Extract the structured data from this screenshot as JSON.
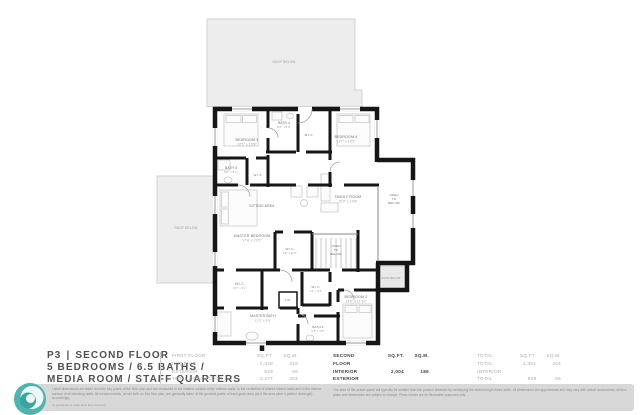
{
  "title_block": {
    "page_label": "P3",
    "separator": "|",
    "floor_label": "SECOND FLOOR",
    "line2": "5 BEDROOMS / 6.5 BATHS /",
    "line3": "MEDIA ROOM / STAFF QUARTERS"
  },
  "colors": {
    "wall": "#161616",
    "roof_fill": "#ededed",
    "accent_teal": "#4db5ad",
    "muted_text": "#9a9a9a",
    "dark_text": "#3d3d3d"
  },
  "tables": [
    {
      "header": {
        "label": "FIRST FLOOR",
        "col1": "SQ.FT.",
        "col2": "SQ.M."
      },
      "rows": [
        [
          "INTERIOR",
          "2,348",
          "218"
        ],
        [
          "EXTERIOR",
          "929",
          "86"
        ],
        [
          "TOTAL FIRST FLOOR",
          "3,277",
          "304"
        ]
      ]
    },
    {
      "header": {
        "label": "SECOND FLOOR",
        "col1": "SQ.FT.",
        "col2": "SQ.M."
      },
      "rows": [
        [
          "INTERIOR",
          "2,004",
          "186"
        ],
        [
          "EXTERIOR",
          "",
          ""
        ],
        [
          "TOTAL SECOND FLOOR",
          "2,004",
          "186"
        ]
      ]
    },
    {
      "header": {
        "label": "TOTAL",
        "col1": "SQ.FT.",
        "col2": "SQ.M."
      },
      "rows": [
        [
          "TOTAL INTERIOR",
          "4,352",
          "404"
        ],
        [
          "TOTAL EXTERIOR",
          "929",
          "86"
        ],
        [
          "TOTAL",
          "5,281",
          "490"
        ]
      ]
    }
  ],
  "disclaimer": {
    "left": "Listed dimensions are taken from the key points of the floor plan and are measured to the exterior surface of the exterior walls, to the centerline of shared interior walls and to the interior surface of all demising walls. All measurements, as set forth on this floor plan, are generally taken at the greatest points of each given area (as if the area were a perfect rectangle). Accordingly,",
    "left_small": "no guarantee is made as to their accuracy.",
    "right": "The area of the actual space will typically be smaller than the product obtained by multiplying the stated length times width. All dimensions are approximate and may vary with actual construction; all floor plans and dimensions are subject to change. Plans shown are for illustrative purposes only."
  },
  "plan": {
    "labels": [
      {
        "id": "roof-below-top",
        "x": 284,
        "y": 63,
        "size": 3.2,
        "color": "#9a9a9a",
        "uniform": true,
        "lines": [
          "ROOF BELOW"
        ]
      },
      {
        "id": "roof-below-left",
        "x": 186,
        "y": 229,
        "size": 3.2,
        "color": "#9a9a9a",
        "uniform": true,
        "lines": [
          "ROOF BELOW"
        ]
      },
      {
        "id": "roof-below-right",
        "x": 391,
        "y": 279,
        "size": 2.6,
        "color": "#8f8f8f",
        "uniform": true,
        "lines": [
          "ROOF BELOW"
        ]
      },
      {
        "id": "bedroom-3",
        "x": 247,
        "y": 141,
        "size": 3.6,
        "lines": [
          "BEDROOM 3",
          "12'1\" x 13'9\""
        ]
      },
      {
        "id": "bath-4",
        "x": 284,
        "y": 124,
        "size": 3.2,
        "lines": [
          "BATH 4",
          "8'0\" x 5'5\""
        ]
      },
      {
        "id": "wic-top",
        "x": 309,
        "y": 136,
        "size": 3.0,
        "uniform": true,
        "lines": [
          "W.I.C."
        ]
      },
      {
        "id": "bedroom-4",
        "x": 346,
        "y": 138,
        "size": 3.6,
        "lines": [
          "BEDROOM 4",
          "13'7\" x 13'2\""
        ]
      },
      {
        "id": "bath-3",
        "x": 231,
        "y": 169,
        "size": 3.2,
        "lines": [
          "BATH 3",
          "9'6\" x 8'1\""
        ]
      },
      {
        "id": "wic-bath3",
        "x": 258,
        "y": 176,
        "size": 3.0,
        "uniform": true,
        "lines": [
          "W.I.C."
        ]
      },
      {
        "id": "sitting-area",
        "x": 262,
        "y": 207,
        "size": 3.4,
        "uniform": true,
        "lines": [
          "SITTING AREA"
        ]
      },
      {
        "id": "master-bedroom",
        "x": 252,
        "y": 237,
        "size": 3.6,
        "lines": [
          "MASTER BEDROOM",
          "17'4\" x 21'0\""
        ]
      },
      {
        "id": "family-room",
        "x": 348,
        "y": 198,
        "size": 3.6,
        "lines": [
          "FAMILY ROOM",
          "15'0\" x 14'8\""
        ]
      },
      {
        "id": "open-to-below-right",
        "x": 394,
        "y": 196,
        "size": 3.0,
        "uniform": true,
        "lines": [
          "OPEN",
          "TO",
          "BELOW"
        ]
      },
      {
        "id": "open-to-below-center",
        "x": 336,
        "y": 247,
        "size": 3.0,
        "uniform": true,
        "lines": [
          "OPEN",
          "TO",
          "BELOW"
        ]
      },
      {
        "id": "wic-center",
        "x": 290,
        "y": 250,
        "size": 3.0,
        "lines": [
          "W.I.C.",
          "4'8\" x 11'5\""
        ]
      },
      {
        "id": "wic-bottom-left",
        "x": 240,
        "y": 285,
        "size": 3.2,
        "lines": [
          "W.I.C.",
          "9'2\" x 9'1\""
        ]
      },
      {
        "id": "linen-closet",
        "x": 288,
        "y": 301,
        "size": 2.8,
        "uniform": true,
        "lines": [
          "LIN."
        ]
      },
      {
        "id": "wic-small",
        "x": 316,
        "y": 288,
        "size": 3.0,
        "lines": [
          "W.I.C.",
          "4'4\" x 5'5\""
        ]
      },
      {
        "id": "bedroom-2",
        "x": 356,
        "y": 298,
        "size": 3.6,
        "lines": [
          "BEDROOM 2",
          "12'6\" x 11'10\""
        ]
      },
      {
        "id": "master-bath",
        "x": 263,
        "y": 317,
        "size": 3.4,
        "lines": [
          "MASTER BATH",
          "11'5\" x 9'9\""
        ]
      },
      {
        "id": "bath-2",
        "x": 318,
        "y": 328,
        "size": 3.0,
        "lines": [
          "BATH 2",
          "6'8\" x 5'6\""
        ]
      }
    ]
  }
}
